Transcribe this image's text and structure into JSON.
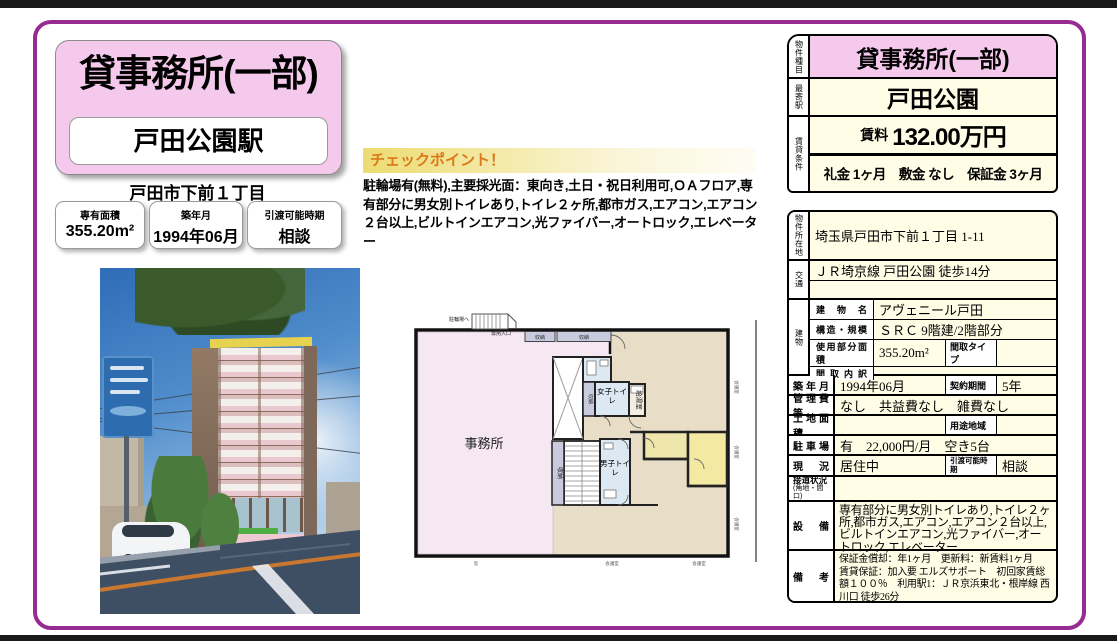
{
  "colors": {
    "accent_pink": "#F5C9EC",
    "cream": "#FFFDE5",
    "frame_purple": "#982B92",
    "checkpoint_orange": "#DC7818"
  },
  "header": {
    "property_type": "貸事務所(一部)",
    "station": "戸田公園駅",
    "district": "戸田市下前１丁目"
  },
  "stats": [
    {
      "label": "専有面積",
      "value": "355.20m²"
    },
    {
      "label": "築年月",
      "value": "1994年06月"
    },
    {
      "label": "引渡可能時期",
      "value": "相談"
    }
  ],
  "checkpoint": {
    "title": "チェックポイント！",
    "body": "駐輪場有(無料),主要採光面：東向き,土日・祝日利用可,ＯＡフロア,専有部分に男女別トイレあり,トイレ２ヶ所,都市ガス,エアコン,エアコン２台以上,ビルトインエアコン,光ファイバー,オートロック,エレベーター"
  },
  "summary": {
    "type_label": "物件種目",
    "type_value": "貸事務所(一部)",
    "station_label": "最寄駅",
    "station_value": "戸田公園",
    "terms_label": "賃貸条件",
    "rent_label": "賃料",
    "rent_value": "132.00万円",
    "initial_fees": "礼金 1ヶ月　敷金 なし　保証金 3ヶ月"
  },
  "detail": {
    "location_label": "物件所在地",
    "location_value": "埼玉県戸田市下前１丁目 1-11",
    "access_label": "交通",
    "access_value": "ＪＲ埼京線 戸田公園 徒歩14分",
    "building_label": "建物",
    "building_name_label": "建物名",
    "building_name": "アヴェニール戸田",
    "structure_label": "構造・規模",
    "structure": "ＳＲＣ 9階建/2階部分",
    "used_area_label": "使用部分面積",
    "used_area": "355.20m²",
    "madori_type_label": "間取タイプ",
    "madori_type": "",
    "madori_detail_label": "間取内訳",
    "madori_detail": "",
    "built_label": "築年月",
    "built": "1994年06月",
    "contract_label": "契約期間",
    "contract": "5年",
    "fees_label": "管理費等",
    "fees": "なし　共益費なし　雑費なし",
    "land_label": "土地面積",
    "land": "",
    "zoning_label": "用途地域",
    "zoning": "",
    "parking_label": "駐車場",
    "parking": "有　22,000円/月　空き5台",
    "status_label": "現況",
    "status": "居住中",
    "handover_label": "引渡可能時期",
    "handover": "相談",
    "road_label": "接道状況",
    "road_label2": "(角地・間口)",
    "road": "",
    "equipment_label": "設備",
    "equipment": "専有部分に男女別トイレあり,トイレ２ヶ所,都市ガス,エアコン,エアコン２台以上,ビルトインエアコン,光ファイバー,オートロック,エレベーター",
    "notes_label": "備考",
    "notes": "保証金償却：年1ヶ月　更新料：新賃料1ヶ月　賃貸保証：加入要 エルズサポート　初回家賃総額１００％　利用駅1：ＪＲ京浜東北・根岸線 西川口 徒歩26分"
  },
  "floorplan": {
    "office": "事務所",
    "womens_toilet": "女子トイレ",
    "mens_toilet": "男子トイレ",
    "kitchenette": "給湯室",
    "storage_top1": "収納",
    "storage_top2": "収納",
    "storage_mid": "収納",
    "storage_stair": "収納",
    "bike_note": "駐輪場へ",
    "entrance_note": "専用入口",
    "bottom_labels": [
      "窓",
      "会議室",
      "会議室"
    ],
    "side_labels": [
      "会議室",
      "会議室",
      "会議室"
    ]
  }
}
